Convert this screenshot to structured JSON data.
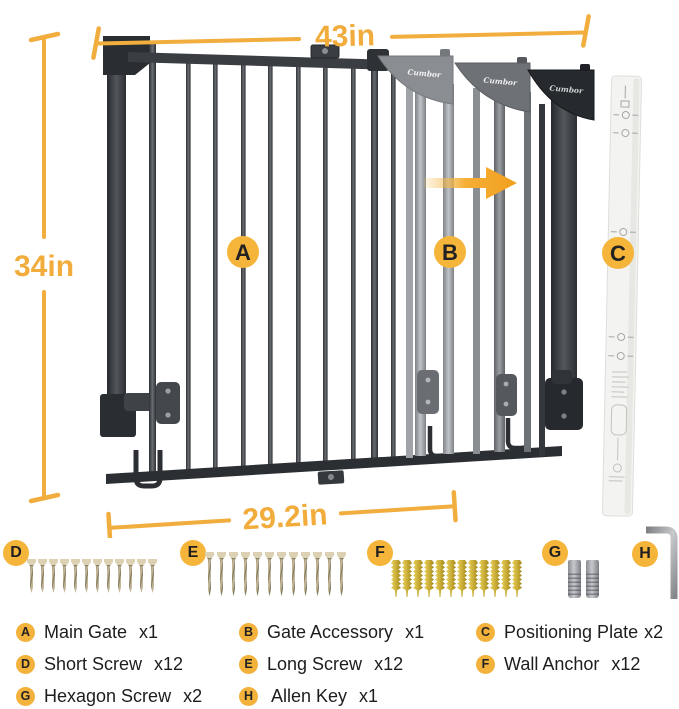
{
  "product": {
    "brand": "Cumbor"
  },
  "dimensions": {
    "width_label": "43in",
    "height_label": "34in",
    "opening_label": "29.2in"
  },
  "plate": {
    "bottom_text": "34in"
  },
  "callouts": {
    "a": "A",
    "b": "B",
    "c": "C",
    "d": "D",
    "e": "E",
    "f": "F",
    "g": "G",
    "h": "H"
  },
  "hardware": {
    "short_screws": {
      "count": 12
    },
    "long_screws": {
      "count": 12
    },
    "wall_anchors": {
      "count": 12
    },
    "hex_screws": {
      "count": 2
    },
    "allen_key": {
      "count": 1
    }
  },
  "legend": {
    "items": [
      {
        "key": "A",
        "name": "Main Gate",
        "qty": "x1"
      },
      {
        "key": "B",
        "name": "Gate Accessory",
        "qty": "x1"
      },
      {
        "key": "C",
        "name": "Positioning Plate",
        "qty": "x2"
      },
      {
        "key": "D",
        "name": "Short Screw",
        "qty": "x12"
      },
      {
        "key": "E",
        "name": "Long Screw",
        "qty": "x12"
      },
      {
        "key": "F",
        "name": "Wall Anchor",
        "qty": "x12"
      },
      {
        "key": "G",
        "name": "Hexagon Screw",
        "qty": "x2"
      },
      {
        "key": "H",
        "name": "Allen Key",
        "qty": "x1"
      }
    ]
  },
  "colors": {
    "accent_amber": "#F1AD3E",
    "badge_amber": "#F5B43A",
    "gate_dark": "#2E3135",
    "gate_light": "#A4A7AC",
    "anchor_gold": "#C9AC35",
    "plate_fill": "#F3F3F1"
  }
}
